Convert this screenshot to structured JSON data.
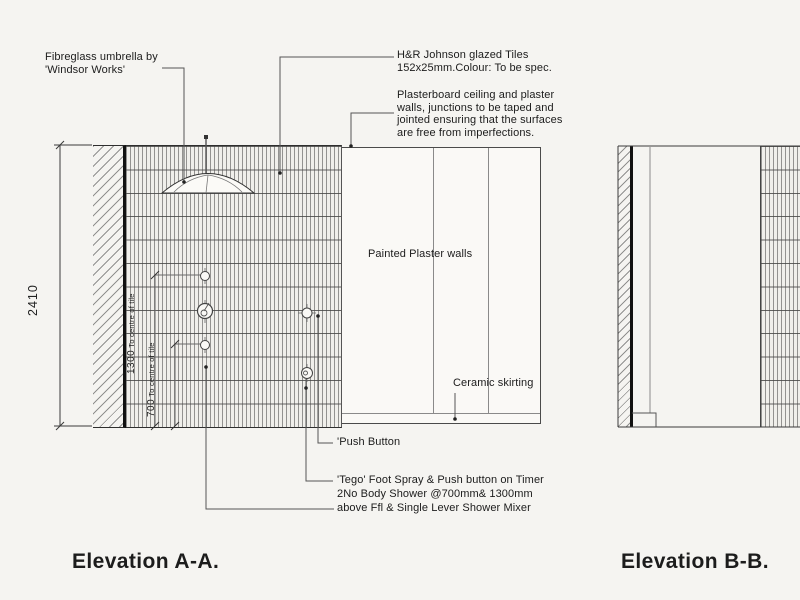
{
  "titles": {
    "elevation_a": "Elevation A-A.",
    "elevation_b": "Elevation B-B."
  },
  "annotations": {
    "umbrella": [
      "Fibreglass umbrella by",
      "'Windsor Works'"
    ],
    "glazed_tiles": [
      "H&R Johnson glazed Tiles",
      "152x25mm.Colour: To be spec."
    ],
    "plasterboard": [
      "Plasterboard ceiling and plaster",
      "walls, junctions to be taped and",
      "jointed ensuring that the surfaces",
      "are free from imperfections."
    ],
    "painted_walls": "Painted Plaster walls",
    "ceramic_skirting": "Ceramic skirting",
    "push_button": "'Push Button",
    "tego_foot_spray": "'Tego' Foot Spray & Push button on Timer",
    "body_shower": [
      "2No Body Shower @700mm& 1300mm",
      "above Ffl & Single Lever Shower Mixer"
    ]
  },
  "dimensions": {
    "wall_height": "2410",
    "dim_1300_value": "1300",
    "dim_1300_suffix": " To centre of tile",
    "dim_700_value": "700",
    "dim_700_suffix": " To centre of tile"
  },
  "colors": {
    "paper": "#f5f4f1",
    "line": "#2e2e2e",
    "tile_line": "#7a7a7a"
  }
}
